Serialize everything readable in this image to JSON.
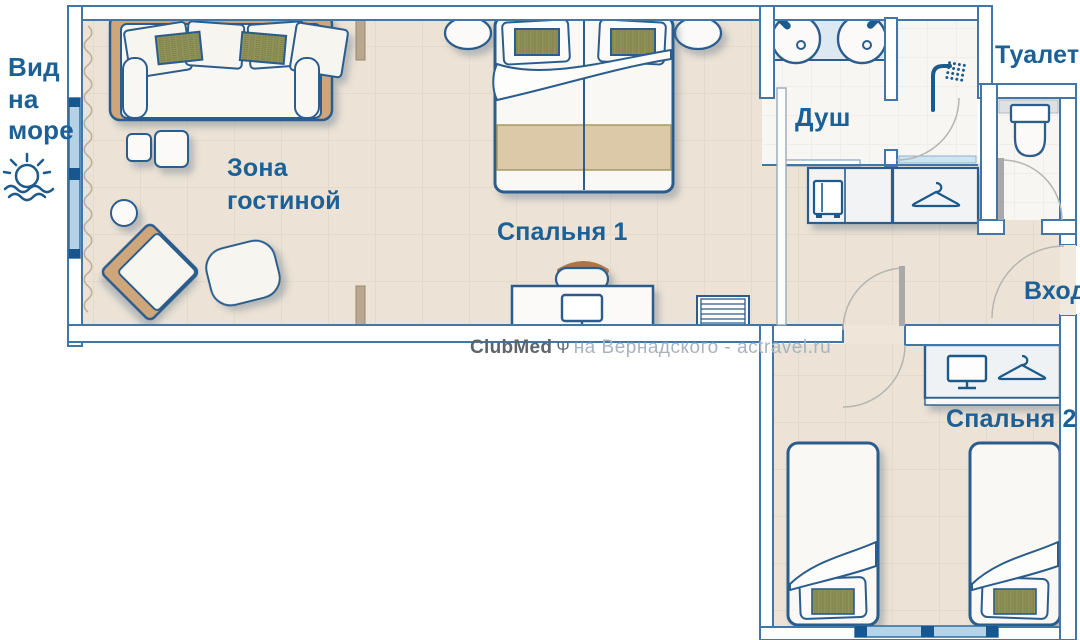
{
  "plan": {
    "title": "hotel-suite-floorplan",
    "labels": {
      "sea_view": "Вид\nна\nморе",
      "living_area": "Зона\nгостиной",
      "bedroom1": "Спальня 1",
      "shower": "Душ",
      "toilet": "Туалет",
      "entrance": "Вход",
      "bedroom2": "Спальня 2"
    },
    "watermark": {
      "brand": "ClubMed",
      "logo": "Ψ",
      "site": "на Вернадского - actravel.ru"
    },
    "icons": {
      "sea_view": "sun-over-waves",
      "shower": "shower-head",
      "wardrobe": "clothes-hanger",
      "tv": "monitor",
      "minibar": "fridge",
      "toilet": "toilet-bowl",
      "sink": "round-basin",
      "logo": "trident"
    },
    "colors": {
      "wall_line": "#4077a8",
      "furniture_line": "#2c5d8d",
      "label_text": "#1b6096",
      "floor_beige": "#ece2d5",
      "floor_tile": "#f8f6f2",
      "window_glass": "#b5d2e6",
      "wood": "#cfa67a",
      "olive_cushion": "#90945a"
    }
  }
}
